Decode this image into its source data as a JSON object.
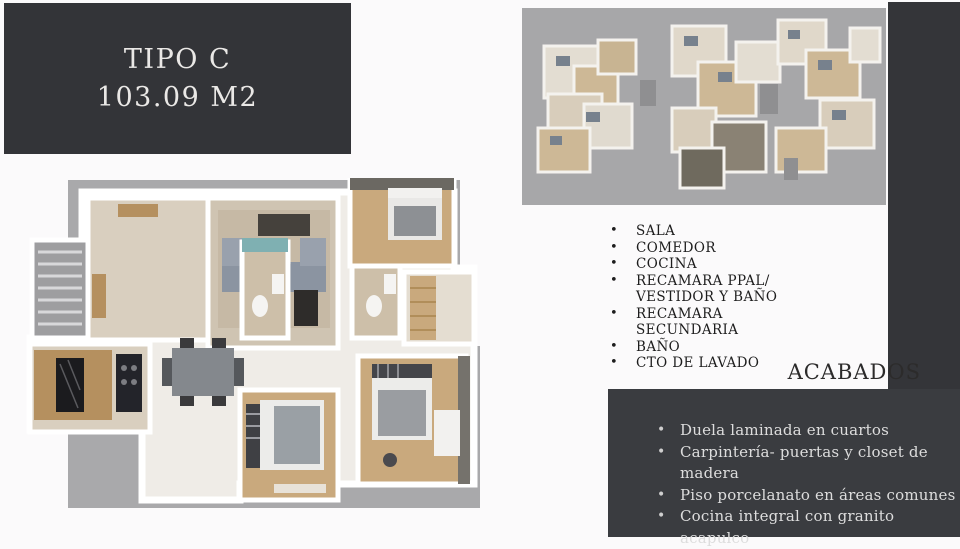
{
  "slide": {
    "title_line1": "TIPO C",
    "title_line2": "103.09 M2"
  },
  "rooms": {
    "bullet": "•",
    "items": [
      "SALA",
      "COMEDOR",
      "COCINA",
      "RECAMARA PPAL/\nVESTIDOR Y BAÑO",
      "RECAMARA\nSECUNDARIA",
      "BAÑO",
      "CTO DE LAVADO"
    ]
  },
  "acabados": {
    "title": "ACABADOS",
    "bullet": "•",
    "items": [
      "Duela laminada en cuartos",
      "Carpintería- puertas y closet de\nmadera",
      "Piso porcelanato en áreas comunes",
      "Cocina integral con granito acapulco"
    ]
  },
  "colors": {
    "panel_dark": "#333438",
    "strip_dark": "#343539",
    "box_dark": "#3a3c40",
    "title_text": "#eae8e6",
    "body_text": "#1d1d1d",
    "box_text": "#dddddd",
    "page_bg": "#fbfafb",
    "render_ground": "#a9a9ab",
    "floor_beige": "#d5cab7",
    "floor_wood": "#c9a97d",
    "bath_teal": "#7fb0b2",
    "sofa_gray": "#8b94a1",
    "counter_black": "#1b1b1e"
  }
}
